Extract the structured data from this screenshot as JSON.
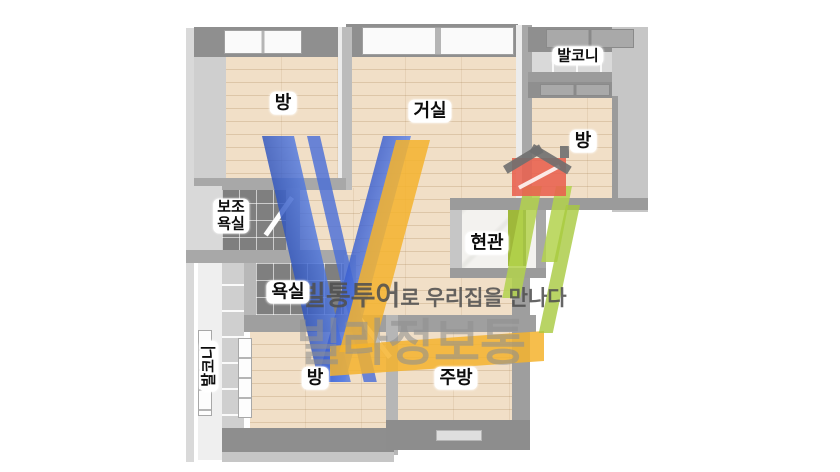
{
  "canvas": {
    "background": "#ffffff"
  },
  "floorplan": {
    "rooms": {
      "room_top_left": "방",
      "living_room": "거실",
      "balcony_top": "발코니",
      "room_right": "방",
      "aux_bath_line1": "보조",
      "aux_bath_line2": "욕실",
      "entrance": "현관",
      "bathroom": "욕실",
      "balcony_left": "발코니",
      "room_bottom": "방",
      "kitchen": "주방"
    },
    "materials": {
      "wall_color": "#9b9b9b",
      "wood_floor_color": "#f1dfc7",
      "bath_tile_color": "#7f7f7f",
      "entrance_floor_color": "#f3f2ef",
      "entrance_door_color": "#9fb83a"
    }
  },
  "watermark": {
    "brand_text": "빌라정보통",
    "tagline_brand": "빌통투어",
    "tagline_rest": "로 우리집을 만나다",
    "logo": {
      "letter_v_color": "#4a6fd8",
      "letter_l_color": "#f5b32d",
      "slash_color": "#b3d24c",
      "house_color": "#e8614e",
      "roof_color": "#6f6f6f"
    },
    "brand_text_color": "#919191",
    "tagline_color": "#555555"
  }
}
